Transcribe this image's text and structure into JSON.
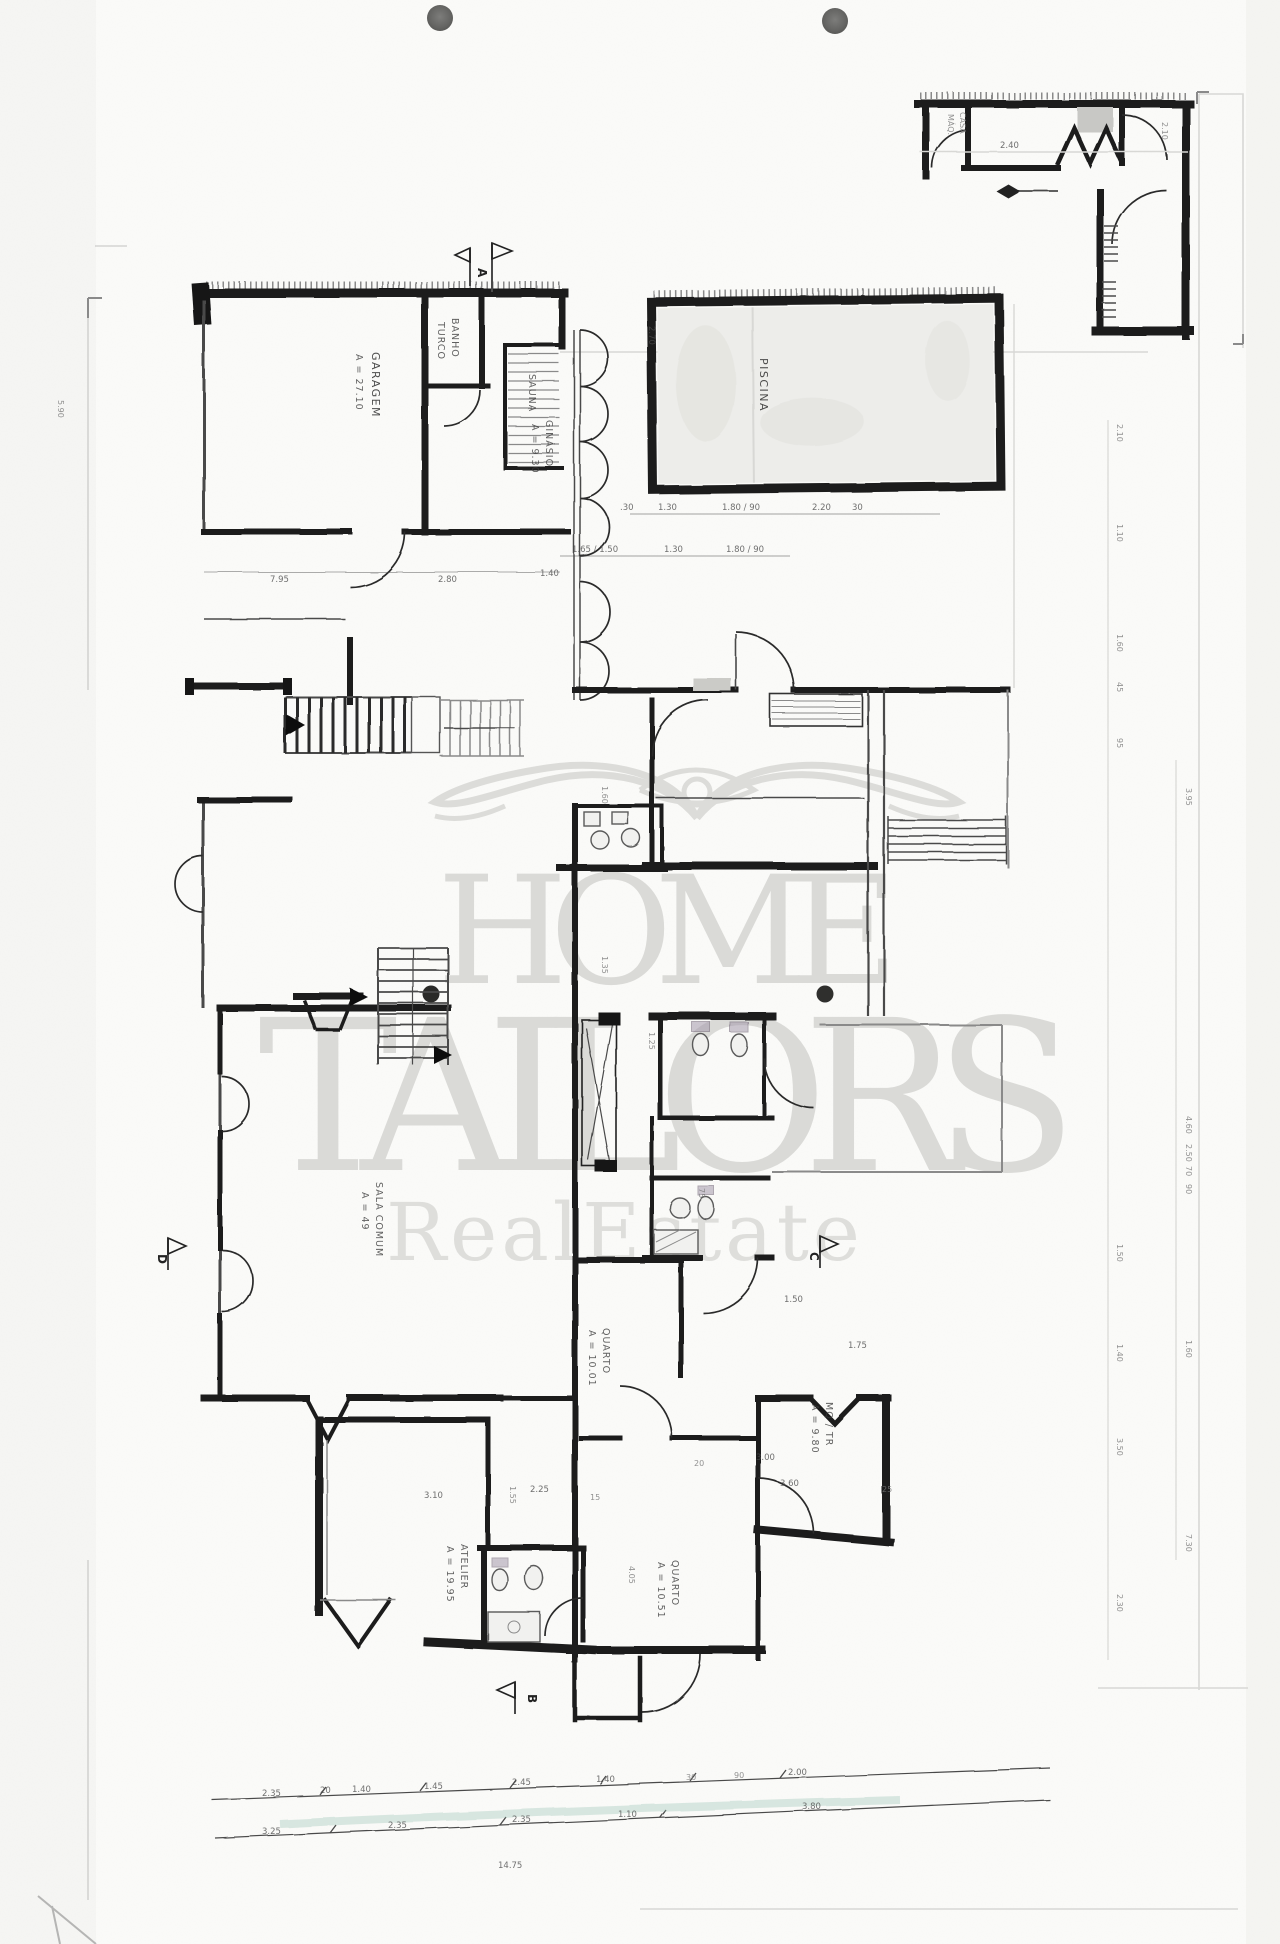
{
  "watermark": {
    "word1": "HOME",
    "word2": "TAILORS",
    "tagline": "R e a l   E s t a t e"
  },
  "rooms": {
    "garagem": {
      "name": "GARAGEM",
      "area": "A = 27.10"
    },
    "banho_turco": {
      "name": "BANHO",
      "name2": "TURCO"
    },
    "sauna": {
      "name": "SAUNA"
    },
    "ginasio": {
      "name": "GINÁSIO",
      "area": "A = 9.30"
    },
    "piscina": {
      "name": "PISCINA"
    },
    "casa_maquinas": {
      "name": "CASA",
      "name2": "MÁQ."
    },
    "sala_comum": {
      "name": "SALA COMUM",
      "area": "A = 49"
    },
    "quarto_meio": {
      "name": "QUARTO",
      "area": "A = 10.01"
    },
    "mq_tr": {
      "name": "MQ / TR",
      "area": "A = 9.80"
    },
    "atelier": {
      "name": "ATELIER",
      "area": "A = 19.95"
    },
    "quarto_baixo": {
      "name": "QUARTO",
      "area": "A = 10.51"
    }
  },
  "section_markers": {
    "a": "A",
    "b": "B",
    "c": "C",
    "d": "D"
  },
  "dims": {
    "left_small": "5.90",
    "garage_row": [
      "7.95",
      "2.80",
      "1.40"
    ],
    "pool_vert": "2.70",
    "pool_row1": [
      ".30",
      "1.30",
      "1.80 / 90",
      "2.20",
      "30"
    ],
    "pool_row2": [
      "1.65 / 1.50",
      "1.30",
      "1.80 / 90"
    ],
    "annex": [
      "2.40",
      "2.10"
    ],
    "mid": [
      "1.60",
      "1.35",
      "1.25",
      "1.50",
      "1.75",
      "75"
    ],
    "lower": [
      "3.10",
      "2.25",
      "1.55",
      "15",
      "4.05",
      "3.00",
      "20",
      "3.60",
      "25"
    ],
    "bottom_row1": [
      "2.35",
      "20",
      "1.40",
      "1.45",
      "2.45",
      "1.40",
      "30",
      "90",
      "2.00"
    ],
    "bottom_row2": [
      "3.25",
      "2.35",
      "2.35",
      "1.10",
      "3.80"
    ],
    "total": "14.75",
    "right_col1": [
      "2.10",
      "1.10",
      "1.60",
      "45",
      "95",
      "1.50",
      "1.40",
      "3.50",
      "2.30"
    ],
    "right_col2": [
      "3.95",
      "4.60",
      "2.50",
      "70",
      "90",
      "1.60",
      "7.30"
    ]
  },
  "colors": {
    "ink": "#1b1b1b",
    "pencil": "#777777",
    "watermark": "#dadad7",
    "highlight": "#8fbfae",
    "paper": "#fbfbf9"
  }
}
